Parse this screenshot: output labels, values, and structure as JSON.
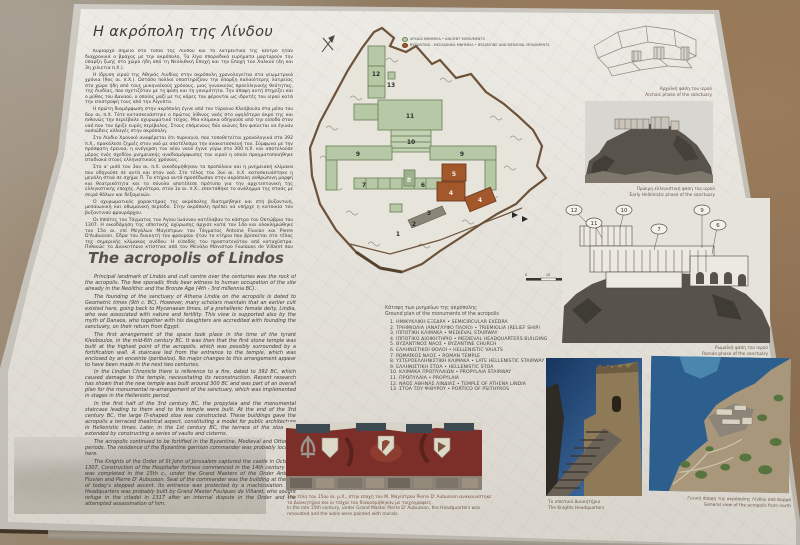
{
  "colors": {
    "ancient_monuments": "#b7c8a6",
    "medieval_monuments": "#a3582c",
    "panel_face": "#e3e0d9",
    "caption_brown": "#6b5747"
  },
  "greek": {
    "title": "Η ακρόπολη της Λίνδου",
    "paragraphs": [
      "Κυρίαρχο σημείο στο τοπίο της Λίνδου και το λατρευτικό της κέντρο ήταν διαχρονικά ο βράχος με την ακρόπολη. Τα λίγα σποραδικά ευρήματα μαρτυρούν την ύπαρξη ζωής στο χώρο ήδη από τη Νεολιθική Εποχή και την Εποχή του Χαλκού (4η και 3η χιλιετία π.Χ.).",
      "Η ίδρυση ιερού της Αθηνάς Λινδίας στην ακρόπολη χρονολογείται στα γεωμετρικά χρόνια (9ος αι. π.Χ.). Ωστόσο πολλοί υποστηρίζουν την ύπαρξη παλαιότερης λατρείας στο χώρο ήδη από τους μυκηναϊκούς χρόνους, μιας γυναικείας προελληνικής θεότητας, της Λινδίας, που σχετιζόταν με τη φύση και τη γονιμότητα. Την άποψη αυτή στηρίζει και ο μύθος του Δαναού, ο οποίος μαζί με τις κόρες του φέρονται ως ιδρυτές του ιερού κατά την επιστροφή τους από την Αίγυπτο.",
      "Η πρώτη διαμόρφωση στην ακρόπολη έγινε από τον τύραννο Κλεόβουλο στα μέσα του 6ου αι. π.Χ. Τότε κατασκευάστηκε ο πρώτος λίθινος ναός στο υψηλότερο άκρο της και πιθανώς την περιέβαλε οχυρωματικό τείχος. Μια κλίμακα οδηγούσε από την είσοδο στον ναό που τον όριζε ευρύς περίβολος. Στους επόμενους δύο αιώνες δεν φαίνεται να έγιναν ουσιώδεις αλλαγές στην ακρόπολη.",
      "Στο Λίνδιο Χρονικό αναφέρεται ότι πυρκαγιά, που τοποθετείται χρονολογικά στο 392 π.Χ., προκάλεσε ζημιές στον ναό με αποτέλεσμα την ανακατασκευή του. Σύμφωνα με την πρόσφατη έρευνα, η ανέγερση του νέου ναού έγινε γύρω στο 300 π.Χ. και αποτελούσε μέρος ενός σχεδίου μνημειακής αναδιαμόρφωσης του ιερού η οποία πραγματοποιήθηκε σταδιακά στους ελληνιστικούς χρόνους.",
      "Στο α' μισό του 3ου αι. π.Χ. οικοδομήθηκαν τα προπύλαια και η μνημειακή κλίμακα που οδηγούσε σε αυτά και στον ναό. Στο τέλος του 3ου αι. π.Χ. κατασκευάστηκε η μεγάλη στοά σε σχήμα Π. Τα κτήρια αυτά προσέδωσαν στην ακρόπολη ανθρώπινη μορφή και θεατρικότητα και το σύνολο αποτέλεσε πρότυπο για την αρχιτεκτονική της ελληνιστικής εποχής. Αργότερα, στον 1ο αι. π.Χ., επεκτάθηκε το ανάλημμα της στοάς με σειρά θόλων και δεξαμενών.",
      "Ο οχυρωματικός χαρακτήρας της ακρόπολης διατηρήθηκε και στη βυζαντινή, μεσαιωνική και οθωμανική περίοδο. Στην ακρόπολη πρέπει να υπήρχε η κατοικία του βυζαντινού φρουράρχου.",
      "Οι Ιππότες του Τάγματος του Αγίου Ιωάννου κατέλαβαν το κάστρο τον Οκτώβριο του 1307. Η οικοδόμηση της ιπποτικής οχύρωσης άρχισε κατά τον 14ο και ολοκληρώθηκε τον 15ο αι. επί Μεγάλων Μαγίστρων του Τάγματος Antoine Fluvian και Pierre D'Aubusson. Έδρα του διοικητή του φρουρίου ήταν το κτήριο που βρίσκεται στο τέλος της σημερινής κλίμακας ανόδου. Η είσοδός του προστατευόταν από καταχύστρα. Πιθανώς το Διοικητήριο κτίστηκε από τον Μεγάλο Μάγιστρο Foulques de Villaret που κατέφυγε στην ακρόπολη το 1317 έπειτα από εσωτερική διαμάχη του τάγματος και την απόπειρα δολοφονίας του.",
      "Στις 30 Σεπτεμβρίου του 1522 η φρουρά της Λίνδου παρέδωσε τα κλειδιά στους Τούρκους, και μικρή τουρκική φρουρά παρέμεινε μέχρι το 1844.",
      "Την περίοδο 1902-1905 πραγματοποιήθηκαν ανασκαφικές έρευνες στην ακρόπολη από τη Δανική Αρχαιολογική αποστολή και κατά την εποχή της Ιταλοκρατίας αναστηλωτικές επεμβάσεις στα μνημεία."
    ]
  },
  "english": {
    "title": "The acropolis of Lindos",
    "paragraphs": [
      "Principal landmark of Lindos and cult centre over the centuries was the rock of the acropolis. The few sporadic finds bear witness to human occupation of the site already in the Neolithic and the Bronze Age (4th - 3rd millennia BC).",
      "The founding of the sanctuary of Athena Lindia on the acropolis is dated to Geometric times (9th c. BC). However, many scholars maintain that an earlier cult existed here, going back to Mycenaean times, of a prehellenic female deity, Lindia, who was associated with nature and fertility. This view is supported also by the myth of Danaos, who together with his daughters are accredited with founding the sanctuary, on their return from Egypt.",
      "The first arrangement of the space took place in the time of the tyrant Kleoboulos, in the mid-6th century BC. It was then that the first stone temple was built at the highest point of the acropolis, which was possibly surrounded by a fortification wall. A staircase led from the entrance to the temple, which was enclosed by an enceinte (peribolos). No major changes to this arrangement appear to have been made in the next two centuries.",
      "In the Lindian Chronicle there is reference to a fire, dated to 392 BC, which caused damage to the temple, necessitating its reconstruction. Recent research has shown that the new temple was built around 300 BC and was part of an overall plan for the monumental re-arrangement of the sanctuary, which was implemented in stages in the Hellenistic period.",
      "In the first half of the 3rd century BC, the propylaia and the monumental staircase leading to them and to the temple were built. At the end of the 3rd century BC, the large Π-shaped stoa was constructed. These buildings gave the acropolis a terraced theatrical aspect, constituting a model for public architecture in Hellenistic times. Later, in the 1st century BC, the terrace of the stoa was extended by constructing a series of vaults and cisterns.",
      "The acropolis continued to be fortified in the Byzantine, Medieval and Ottoman periods. The residence of the Byzantine garrison commander was probably located here.",
      "The Knights of the Order of St John of Jerusalem captured the castle in October 1307. Construction of the Hospitaller fortress commenced in the 14th century and was completed in the 15th c., under the Grand Masters of the Order Antoine Fluvian and Pierre D' Aubusson. Seat of the commander was the building at the top of today's stepped ascent. Its entrance was protected by a machicolation. The Headquarters was probably built by Grand Master Foulques de Villaret, who sought refuge in the citadel in 1317 after an internal dispute in the Order and the attempted assassination of him.",
      "On 30 September 1522 the garrison of Lindos surrendered the keys of the castle to the Ottoman Turks. A small Turkish garrison remained until 1844.",
      "In the period 1902-1905, the Danish Archaeological Mission conducted excavations on the acropolis; during the Italian occupation, restoration interventions were carried out."
    ]
  },
  "map": {
    "caption_gr": "Κάτοψη των μνημείων της ακρόπολης",
    "caption_en": "Ground plan of the monuments of the acropolis",
    "legend": [
      {
        "label": "ΑΡΧΑΙΑ ΜΝΗΜΕΙΑ • ANCIENT MONUMENTS"
      },
      {
        "label": "ΒΥΖΑΝΤΙΝΑ - ΜΕΣΑΙΩΝΙΚΑ ΜΝΗΜΕΙΑ • BYZANTINE AND MEDIEVAL MONUMENTS"
      }
    ],
    "monuments": [
      "1.  ΗΜΙΚΥΚΛΙΚΗ ΕΞΕΔΡΑ • SEMICIRCULAR EXEDRA",
      "2.  ΤΡΙΗΜΙΟΛΙΑ (ΑΝΑΓΛΥΦΟ ΠΛΟΙΟ) • TRIEMIOLIA (RELIEF SHIP)",
      "3.  ΙΠΠΟΤΙΚΗ ΚΛΙΜΑΚΑ • MEDIEVAL STAIRWAY",
      "4.  ΙΠΠΟΤΙΚΟ ΔΙΟΙΚΗΤΗΡΙΟ • MEDIEVAL HEADQUARTERS BUILDING",
      "5.  ΒΥΖΑΝΤΙΝΟΣ ΝΑΟΣ • BYZANTINE CHURCH",
      "6.  ΕΛΛΗΝΙΣΤΙΚΟΙ ΘΟΛΟΙ • HELLENISTIC VAULTS",
      "7.  ΡΩΜΑΪΚΟΣ ΝΑΟΣ • ROMAN TEMPLE",
      "8.  ΥΣΤΕΡΟΕΛΛΗΝΙΣΤΙΚΗ ΚΛΙΜΑΚΑ • LATE HELLENISTIC STAIRWAY",
      "9.  ΕΛΛΗΝΙΣΤΙΚΗ ΣΤΟΑ • HELLENISTIC STOA",
      "10. ΚΛΙΜΑΚΑ ΠΡΟΠΥΛΑΙΩΝ • PROPYLAIA STAIRWAY",
      "11. ΠΡΟΠΥΛΑΙΑ • PROPYLAIA",
      "12. ΝΑΟΣ ΑΘΗΝΑΣ ΛΙΝΔΙΑΣ • TEMPLE OF ATHENA LINDIA",
      "13. ΣΤΟΑ ΤΟΥ ΨΙΘΥΡΟΥ • PORTICO OF PSITHYROS"
    ],
    "plan_markers": [
      "12",
      "13",
      "11",
      "10",
      "9",
      "9",
      "7",
      "8",
      "6",
      "5",
      "4",
      "4",
      "3",
      "2",
      "1"
    ],
    "scale_ticks": [
      "0",
      "10",
      "30 M"
    ]
  },
  "figures": {
    "archaic": {
      "caption_gr": "Αρχαϊκή φάση του ιερού",
      "caption_en": "Archaic phase of the sanctuary"
    },
    "early_hellenistic": {
      "caption_gr": "Πρώιμη ελληνιστική φάση του ιερού",
      "caption_en": "Early Hellenistic phase of the sanctuary"
    },
    "roman": {
      "caption_gr": "Ρωμαϊκή φάση του ιερού",
      "caption_en": "Roman phase of the sanctuary",
      "callouts": [
        "12",
        "11",
        "10",
        "7",
        "9",
        "6"
      ]
    },
    "mural": {
      "caption_gr": "Στα τέλη του 15ου αι. μ.Χ., στην εποχή του Μ. Μαγίστρου Pierre D' Aubusson ανακαινίστηκε το Διοικητήριο και οι τοίχοι του διακοσμήθηκαν με τοιχογραφίες.",
      "caption_en": "In the late 15th century, under Grand Master Pierre D' Aubusson, the Headquarters was renovated and the walls were painted with murals."
    },
    "headquarters": {
      "caption_gr": "Το ιπποτικό Διοικητήριο",
      "caption_en": "The Knights Headquarters"
    },
    "aerial": {
      "caption_gr": "Γενική άποψη της ακρόπολης Λίνδου από Βορρά",
      "caption_en": "General view of the acropolis from north"
    }
  }
}
